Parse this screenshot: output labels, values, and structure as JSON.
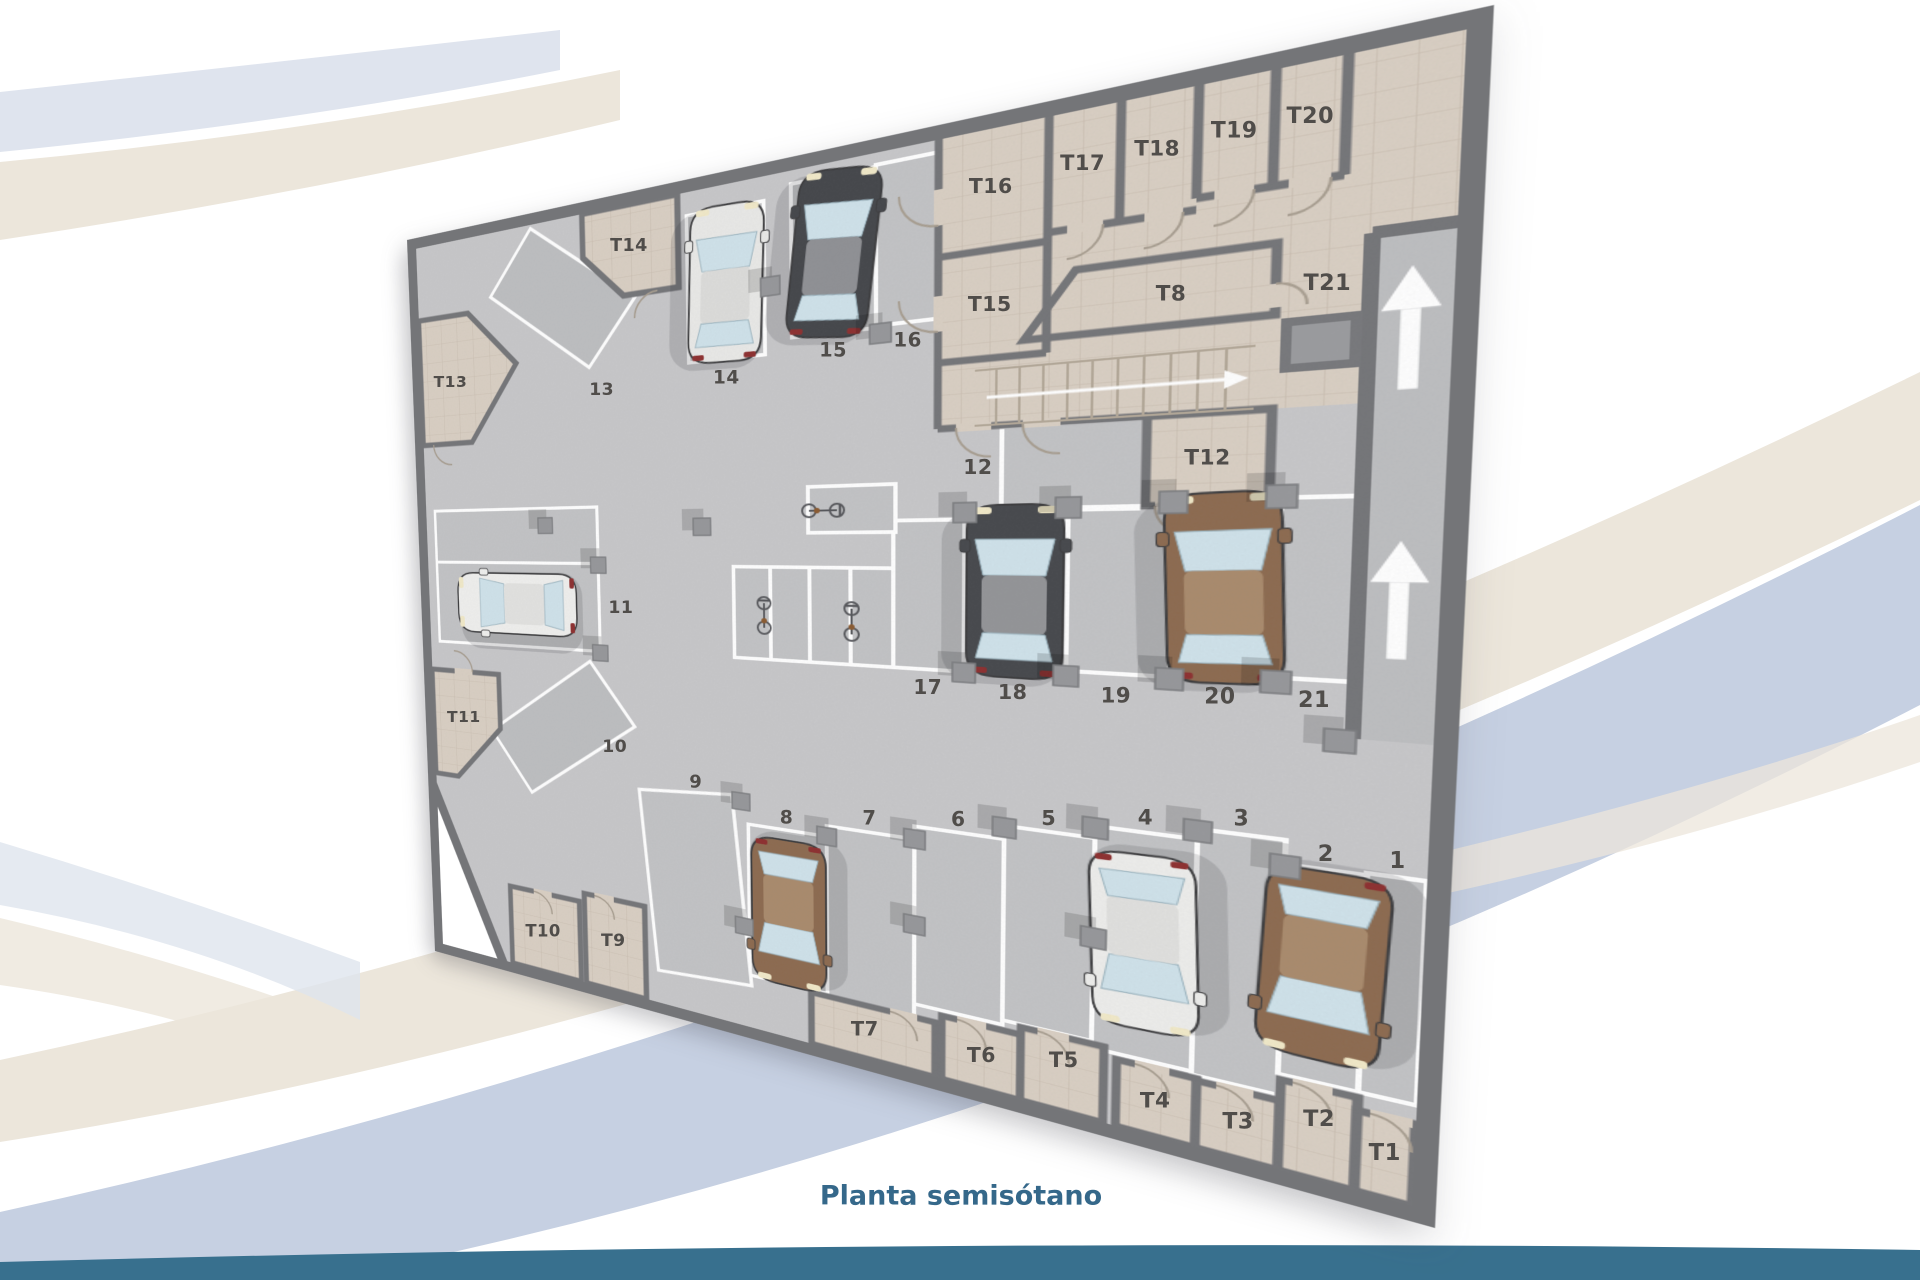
{
  "title": {
    "text": "Planta semisótano",
    "color": "#35688a",
    "x": 961,
    "y": 1196
  },
  "palette": {
    "floor": "#c7c7c9",
    "spot_fill": "#c2c3c5",
    "wall": "#747578",
    "tile_bg": "#d9cfc3",
    "tile_line": "#c9bdaf",
    "spot_line": "#ffffff",
    "label_color": "#504d4a",
    "band_beige": "#ece6db",
    "band_blue": "#c6d0e2",
    "footer_teal": "#38708e"
  },
  "plan": {
    "kind": "parking-garage-floor-plan",
    "parking_labels": [
      {
        "text": "1",
        "u": 968,
        "v": 684
      },
      {
        "text": "2",
        "u": 924,
        "v": 686
      },
      {
        "text": "3",
        "u": 868,
        "v": 664
      },
      {
        "text": "4",
        "u": 800,
        "v": 674
      },
      {
        "text": "5",
        "u": 725,
        "v": 686
      },
      {
        "text": "6",
        "u": 648,
        "v": 700
      },
      {
        "text": "7",
        "u": 565,
        "v": 712
      },
      {
        "text": "8",
        "u": 480,
        "v": 726
      },
      {
        "text": "9",
        "u": 378,
        "v": 698
      },
      {
        "text": "10",
        "u": 278,
        "v": 668
      },
      {
        "text": "11",
        "u": 290,
        "v": 492
      },
      {
        "text": "12",
        "u": 663,
        "v": 338
      },
      {
        "text": "13",
        "u": 272,
        "v": 226
      },
      {
        "text": "14",
        "u": 420,
        "v": 226
      },
      {
        "text": "15",
        "u": 531,
        "v": 208
      },
      {
        "text": "16",
        "u": 601,
        "v": 206
      },
      {
        "text": "17",
        "u": 620,
        "v": 564
      },
      {
        "text": "18",
        "u": 694,
        "v": 562
      },
      {
        "text": "19",
        "u": 776,
        "v": 558
      },
      {
        "text": "20",
        "u": 851,
        "v": 554
      },
      {
        "text": "21",
        "u": 913,
        "v": 551
      }
    ],
    "storage_labels": [
      {
        "text": "T1",
        "u": 968,
        "v": 944
      },
      {
        "text": "T2",
        "u": 926,
        "v": 928
      },
      {
        "text": "T3",
        "u": 872,
        "v": 950
      },
      {
        "text": "T4",
        "u": 812,
        "v": 950
      },
      {
        "text": "T5",
        "u": 740,
        "v": 932
      },
      {
        "text": "T6",
        "u": 670,
        "v": 948
      },
      {
        "text": "T7",
        "u": 560,
        "v": 952
      },
      {
        "text": "T8",
        "u": 810,
        "v": 190
      },
      {
        "text": "T9",
        "u": 270,
        "v": 920
      },
      {
        "text": "T10",
        "u": 172,
        "v": 930
      },
      {
        "text": "T11",
        "u": 62,
        "v": 652
      },
      {
        "text": "T12",
        "u": 838,
        "v": 338
      },
      {
        "text": "T13",
        "u": 60,
        "v": 196
      },
      {
        "text": "T14",
        "u": 310,
        "v": 62
      },
      {
        "text": "T15",
        "u": 672,
        "v": 180
      },
      {
        "text": "T16",
        "u": 672,
        "v": 68
      },
      {
        "text": "T17",
        "u": 744,
        "v": 62
      },
      {
        "text": "T18",
        "u": 798,
        "v": 62
      },
      {
        "text": "T19",
        "u": 850,
        "v": 58
      },
      {
        "text": "T20",
        "u": 898,
        "v": 58
      },
      {
        "text": "T21",
        "u": 912,
        "v": 196
      }
    ],
    "cars": [
      {
        "spot": "2",
        "color": "brown"
      },
      {
        "spot": "4",
        "color": "white"
      },
      {
        "spot": "8",
        "color": "brown"
      },
      {
        "spot": "11",
        "color": "white"
      },
      {
        "spot": "14",
        "color": "silver"
      },
      {
        "spot": "15",
        "color": "black"
      },
      {
        "spot": "18",
        "color": "dark-gray"
      },
      {
        "spot": "20",
        "color": "brown"
      }
    ],
    "bicycles": 3,
    "ramp_arrows": 2
  }
}
